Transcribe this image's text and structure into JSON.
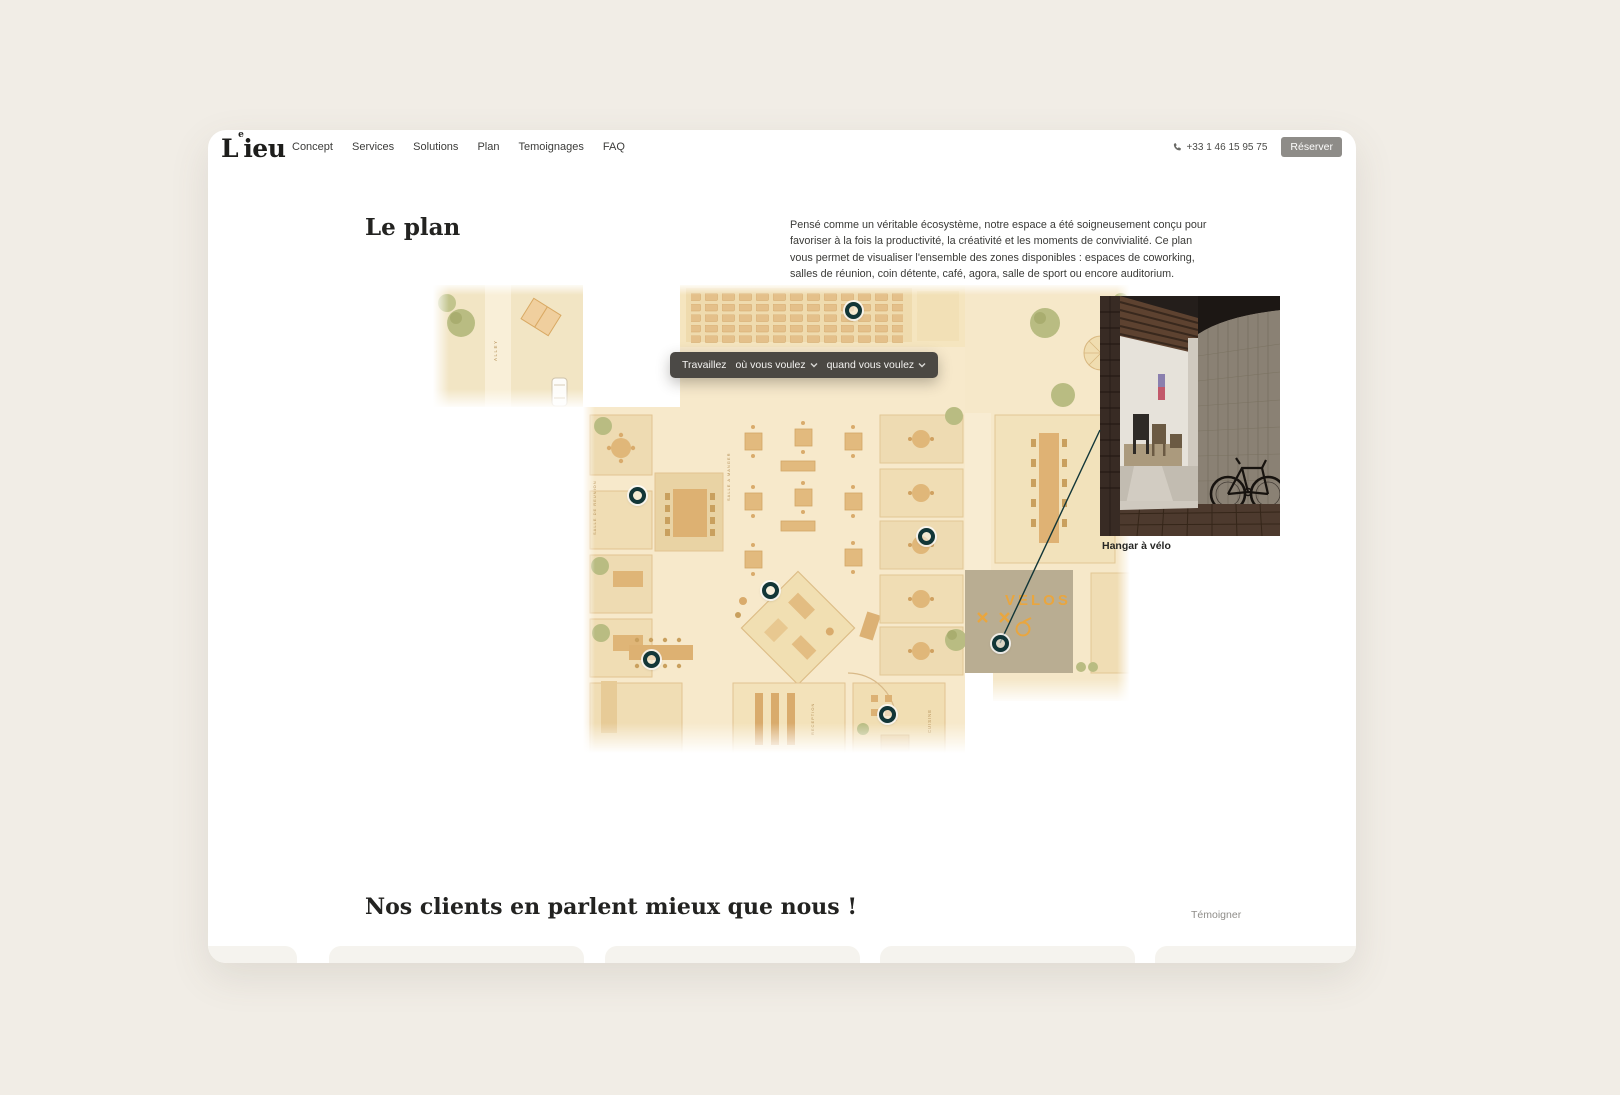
{
  "window": {
    "outer_bg": "#f1ede6",
    "card_bg": "#ffffff"
  },
  "header": {
    "logo": {
      "l": "L",
      "sup": "e",
      "rest": "ieu"
    },
    "nav": [
      {
        "label": "Concept"
      },
      {
        "label": "Services"
      },
      {
        "label": "Solutions"
      },
      {
        "label": "Plan"
      },
      {
        "label": "Temoignages"
      },
      {
        "label": "FAQ"
      }
    ],
    "phone": "+33 1 46 15 95 75",
    "reserve": "Réserver"
  },
  "plan": {
    "title": "Le plan",
    "description": "Pensé comme un véritable écosystème, notre espace a été soigneusement conçu pour favoriser à la fois la productivité, la créativité et les moments de convivialité. Ce plan vous permet de visualiser l'ensemble des zones disponibles : espaces de coworking, salles de réunion, coin détente, café, agora, salle de sport ou encore auditorium.",
    "tooltip": {
      "prefix": "Travaillez",
      "where": "où vous voulez",
      "when": "quand vous voulez"
    },
    "labels": {
      "alley": "ALLEY",
      "salle_reunion": "SALLE DE REUNION",
      "salle_manger": "SALLE A MANGER",
      "velos": "VELOS",
      "reception": "RECEPTION",
      "cuisine": "CUISINE"
    },
    "markers": [
      {
        "x": 645,
        "y": 180
      },
      {
        "x": 429,
        "y": 365
      },
      {
        "x": 718,
        "y": 406
      },
      {
        "x": 562,
        "y": 460
      },
      {
        "x": 443,
        "y": 529
      },
      {
        "x": 679,
        "y": 584
      },
      {
        "x": 792,
        "y": 513
      }
    ],
    "callout_caption": "Hangar à vélo",
    "colors": {
      "marker": "#123638",
      "connector_line": "#123638",
      "velos_accent": "#e8a33d",
      "plan_base": "#f6e8ca"
    }
  },
  "testimonials": {
    "title": "Nos clients en parlent mieux que nous !",
    "action": "Témoigner"
  }
}
